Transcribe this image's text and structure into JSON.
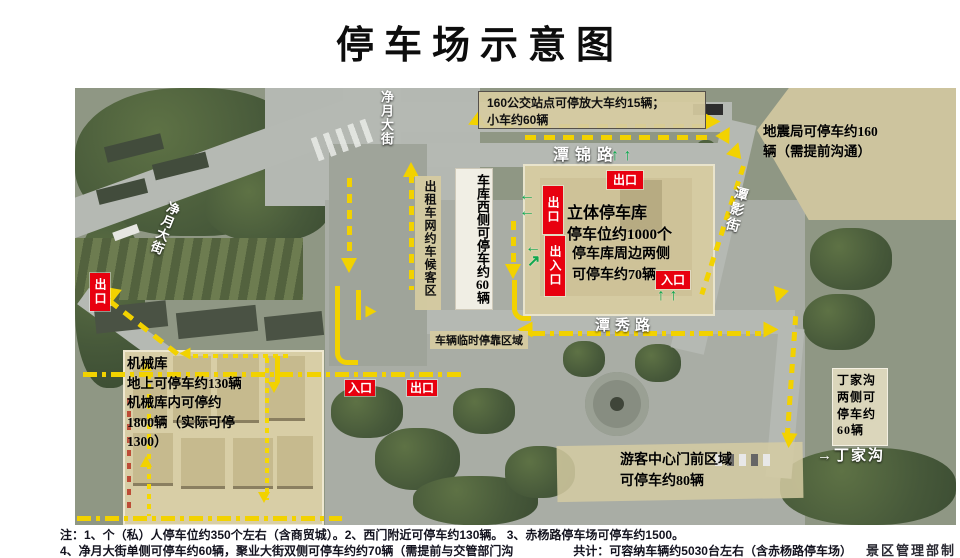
{
  "title": "停车场示意图",
  "roads": {
    "tanjin": "潭锦路",
    "tanxiu": "潭秀路",
    "tanying": "潭影街",
    "jingyue_top": "净月大街",
    "jingyue_diag": "净月大街",
    "dingjiagou_arrow": "→",
    "dingjiagou": "丁家沟"
  },
  "labels": {
    "bus_line1": "160公交站点可停放大车约15辆；",
    "bus_line2": "小车约60辆",
    "seismic": "地震局可停车约160辆（需提前沟通）",
    "taxi": "出租车网约车候客区",
    "garage_west_a": "车库西侧可停车约",
    "garage_west_num": "60",
    "garage_west_b": "辆",
    "temp_stop": "车辆临时停靠区域",
    "garage_line1": "立体停车库",
    "garage_line2": "停车位约1000个",
    "around_line1": "停车库周边两侧",
    "around_line2": "可停车约70辆",
    "mech_line1": "机械库",
    "mech_line2": "地上可停车约130辆",
    "mech_line3": "机械库内可停约",
    "mech_line4": "1800辆（实际可停",
    "mech_line5": "1300）",
    "ding_box": "丁家沟两侧可停车约60辆",
    "visitor_line1": "游客中心门前区域",
    "visitor_line2": "可停车约80辆"
  },
  "gates": {
    "exit": "出口",
    "entrance": "入口",
    "exit_entrance": "出入口"
  },
  "icons": {
    "up_pair": "↑ ↑",
    "left": "←",
    "ne": "↗"
  },
  "notes": {
    "line1": "注：1、个（私）人停车位约350个左右（含商贸城）。2、西门附近可停车约130辆。  3、赤杨路停车场可停车约1500。",
    "line2": "4、净月大街单侧可停车约60辆，聚业大街双侧可停车约约70辆（需提前与交管部门沟通）。",
    "total": "共计：可容纳车辆约5030台左右（含赤杨路停车场）",
    "credit": "景区管理部制"
  },
  "colors": {
    "arrow_yellow": "#f2d200",
    "gate_red": "#e8000f",
    "green_arrow": "#0ea84e",
    "box_tan": "#d6cba0"
  }
}
